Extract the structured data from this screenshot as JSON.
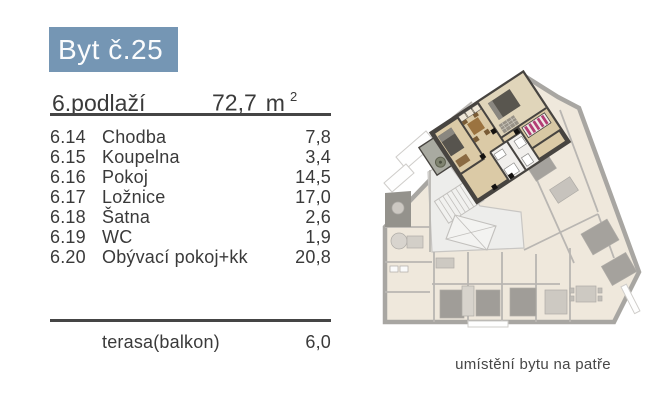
{
  "header": {
    "title": "Byt č.25"
  },
  "summary": {
    "floor": "6.podlaží",
    "area_value": "72,7",
    "area_unit": "m",
    "area_exponent": "2"
  },
  "rooms": [
    {
      "code": "6.14",
      "name": "Chodba",
      "area": "7,8"
    },
    {
      "code": "6.15",
      "name": "Koupelna",
      "area": "3,4"
    },
    {
      "code": "6.16",
      "name": "Pokoj",
      "area": "14,5"
    },
    {
      "code": "6.17",
      "name": "Ložnice",
      "area": "17,0"
    },
    {
      "code": "6.18",
      "name": "Šatna",
      "area": "2,6"
    },
    {
      "code": "6.19",
      "name": "WC",
      "area": "1,9"
    },
    {
      "code": "6.20",
      "name": "Obývací pokoj+kk",
      "area": "20,8"
    }
  ],
  "extras": [
    {
      "name": "terasa(balkon)",
      "area": "6,0"
    }
  ],
  "floorplan": {
    "caption": "umístění bytu na patře"
  },
  "colors": {
    "accent_blue": "#7596b4",
    "body_text": "#3a3a3a",
    "divider": "#454545",
    "highlight_wall": "#474440",
    "highlight_floor": "#dbcaa6",
    "faded_wall": "#a8a6a2",
    "faded_floor": "#efe8dc",
    "wardrobe_pink": "#b23d75"
  }
}
